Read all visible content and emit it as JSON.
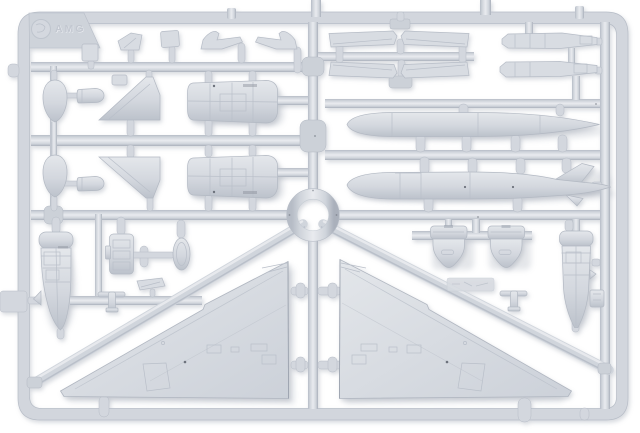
{
  "meta": {
    "type": "photograph",
    "subject": "Injection-moulded light-grey polystyrene model-kit sprue holding parts for a delta-wing jet aircraft",
    "background_color": "#ffffff"
  },
  "colors": {
    "plastic": "#d3d7de",
    "plastic_light": "#e8eaee",
    "plastic_dark": "#b7bdc7",
    "plastic_deep": "#a9afba",
    "shadow": "#98a0ae",
    "background": "#ffffff",
    "detail_line": "#b9bfc9",
    "pin_mark": "#6d727c"
  },
  "sprue": {
    "brand_embossed": "AMG",
    "frame": {
      "shape": "rounded rectangle with internal runners",
      "center_feature": "circular ring"
    },
    "parts_inventory": [
      {
        "name": "delta wing, left",
        "count": 1
      },
      {
        "name": "delta wing, right",
        "count": 1
      },
      {
        "name": "drop tank, plain",
        "count": 1
      },
      {
        "name": "drop tank, finned",
        "count": 1
      },
      {
        "name": "rear fuselage half",
        "count": 2
      },
      {
        "name": "vertical stabilizer",
        "count": 2
      },
      {
        "name": "nose cone / spinner",
        "count": 2
      },
      {
        "name": "forward fuselage half",
        "count": 2
      },
      {
        "name": "engine intake cowl",
        "count": 2
      },
      {
        "name": "elevon / flap",
        "count": 4
      },
      {
        "name": "wing leading-edge strip",
        "count": 2
      },
      {
        "name": "canopy / intake fairing",
        "count": 2
      },
      {
        "name": "underwing pylon",
        "count": 2
      },
      {
        "name": "cockpit tub",
        "count": 1
      },
      {
        "name": "oval hatch",
        "count": 1
      },
      {
        "name": "small pod",
        "count": 2
      },
      {
        "name": "small plates and fittings",
        "count": 6
      }
    ]
  }
}
